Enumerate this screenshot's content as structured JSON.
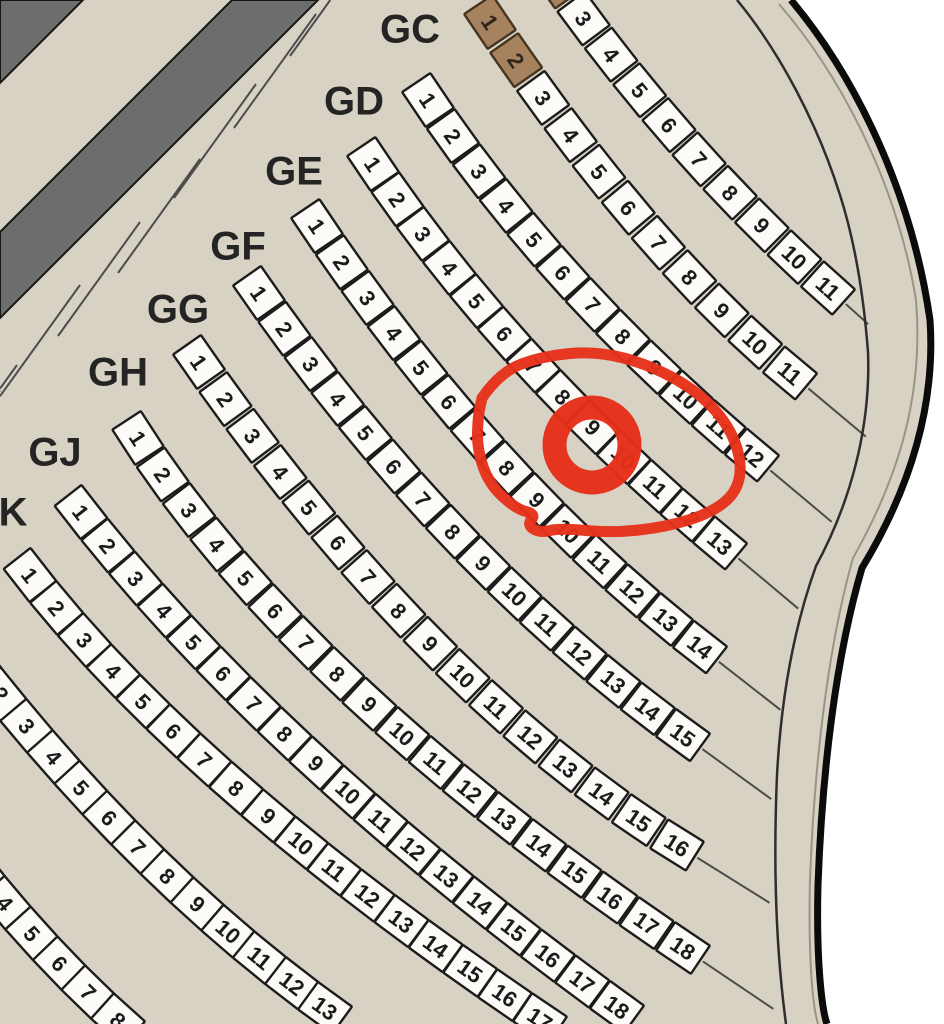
{
  "map": {
    "type": "venue-seating-chart",
    "background_color": "#d7d2c4",
    "outside_color": "#ffffff",
    "seat": {
      "fill": "#fcfbf8",
      "border": "#1c1c1c",
      "number_color": "#1b1b1b",
      "width": 42,
      "height": 34,
      "font_size": 22
    },
    "reserved_seat": {
      "fill": "#a6825e",
      "border": "#46341f",
      "number_color": "#312619"
    },
    "label_style": {
      "color": "#242424",
      "font_size": 40
    },
    "wall": {
      "fill": "#6d6d6d",
      "border": "#161616"
    },
    "boundary": {
      "thick_color": "#0b0b0b",
      "thin_color": "#2e2e2e",
      "faint_color": "#9a9484"
    },
    "divider_color": "#4c4c4c",
    "annotation": {
      "kind": "hand-drawn-red-circle",
      "color": "#e63019",
      "circled_row": "GE",
      "circled_seat_number": 9,
      "ring": {
        "cx": 592,
        "cy": 445,
        "r": 37.5,
        "stroke_width": 24
      },
      "outline_stroke_width": 11,
      "outline_points": [
        [
          482,
          398
        ],
        [
          500,
          372
        ],
        [
          543,
          356
        ],
        [
          597,
          351
        ],
        [
          650,
          365
        ],
        [
          697,
          391
        ],
        [
          728,
          424
        ],
        [
          742,
          461
        ],
        [
          737,
          492
        ],
        [
          711,
          513
        ],
        [
          666,
          527
        ],
        [
          612,
          533
        ],
        [
          560,
          528
        ],
        [
          540,
          533
        ],
        [
          527,
          525
        ],
        [
          536,
          514
        ],
        [
          516,
          509
        ],
        [
          489,
          484
        ],
        [
          477,
          449
        ],
        [
          478,
          416
        ]
      ]
    }
  },
  "rows": [
    {
      "id": "front",
      "label": null,
      "seat_count": 11,
      "numbers": [
        1,
        2,
        3,
        4,
        5,
        6,
        7,
        8,
        9,
        10,
        11
      ],
      "reserved": [
        1,
        2
      ],
      "start": [
        531,
        -56
      ],
      "end": [
        828,
        288
      ],
      "angle_start": 56,
      "angle_end": 42,
      "ext_len": 30
    },
    {
      "id": "GC",
      "label": "GC",
      "label_x": 410,
      "label_y": 28,
      "seat_count": 11,
      "numbers": [
        1,
        2,
        3,
        4,
        5,
        6,
        7,
        8,
        9,
        10,
        11
      ],
      "reserved": [
        1,
        2
      ],
      "start": [
        490,
        22
      ],
      "end": [
        790,
        373
      ],
      "angle_start": 56,
      "angle_end": 40,
      "ext_len": 75
    },
    {
      "id": "GD",
      "label": "GD",
      "label_x": 354,
      "label_y": 100,
      "seat_count": 12,
      "numbers": [
        1,
        2,
        3,
        4,
        5,
        6,
        7,
        8,
        9,
        10,
        11,
        12
      ],
      "reserved": [],
      "start": [
        428,
        100
      ],
      "end": [
        752,
        455
      ],
      "angle_start": 56,
      "angle_end": 40,
      "ext_len": 80
    },
    {
      "id": "GE",
      "label": "GE",
      "label_x": 294,
      "label_y": 170,
      "seat_count": 13,
      "numbers": [
        1,
        2,
        3,
        4,
        5,
        6,
        7,
        8,
        9,
        10,
        11,
        12,
        13
      ],
      "reserved": [],
      "start": [
        373,
        164
      ],
      "end": [
        720,
        543
      ],
      "angle_start": 56,
      "angle_end": 40,
      "ext_len": 78
    },
    {
      "id": "GF",
      "label": "GF",
      "label_x": 238,
      "label_y": 245,
      "seat_count": 14,
      "numbers": [
        1,
        2,
        3,
        4,
        5,
        6,
        7,
        8,
        9,
        10,
        11,
        12,
        13,
        14
      ],
      "reserved": [],
      "start": [
        317,
        226
      ],
      "end": [
        700,
        647
      ],
      "angle_start": 56,
      "angle_end": 38,
      "ext_len": 78
    },
    {
      "id": "GG",
      "label": "GG",
      "label_x": 178,
      "label_y": 308,
      "seat_count": 15,
      "numbers": [
        1,
        2,
        3,
        4,
        5,
        6,
        7,
        8,
        9,
        10,
        11,
        12,
        13,
        14,
        15
      ],
      "reserved": [],
      "start": [
        259,
        293
      ],
      "end": [
        683,
        735
      ],
      "angle_start": 55,
      "angle_end": 36,
      "ext_len": 85
    },
    {
      "id": "GH",
      "label": "GH",
      "label_x": 118,
      "label_y": 371,
      "seat_count": 16,
      "numbers": [
        1,
        2,
        3,
        4,
        5,
        6,
        7,
        8,
        9,
        10,
        11,
        12,
        13,
        14,
        15,
        16
      ],
      "reserved": [],
      "start": [
        199,
        362
      ],
      "end": [
        677,
        845
      ],
      "angle_start": 55,
      "angle_end": 32,
      "ext_len": 85
    },
    {
      "id": "GJ",
      "label": "GJ",
      "label_x": 55,
      "label_y": 451,
      "seat_count": 18,
      "numbers": [
        1,
        2,
        3,
        4,
        5,
        6,
        7,
        8,
        9,
        10,
        11,
        12,
        13,
        14,
        15,
        16,
        17,
        18
      ],
      "reserved": [],
      "start": [
        138,
        438
      ],
      "end": [
        683,
        948
      ],
      "angle_start": 57,
      "angle_end": 34,
      "ext_len": 85
    },
    {
      "id": "K",
      "label": "K",
      "label_x": 13,
      "label_y": 511,
      "seat_count": 18,
      "numbers": [
        1,
        2,
        3,
        4,
        5,
        6,
        7,
        8,
        9,
        10,
        11,
        12,
        13,
        14,
        15,
        16,
        17,
        18
      ],
      "reserved": [],
      "start": [
        81,
        512
      ],
      "end": [
        617,
        1007
      ],
      "angle_start": 52,
      "angle_end": 36,
      "ext_len": 0
    },
    {
      "id": "row-L",
      "label": null,
      "seat_count": 17,
      "numbers": [
        1,
        2,
        3,
        4,
        5,
        6,
        7,
        8,
        9,
        10,
        11,
        12,
        13,
        14,
        15,
        16,
        17
      ],
      "reserved": [],
      "start": [
        30,
        575
      ],
      "end": [
        540,
        1019
      ],
      "angle_start": 52,
      "angle_end": 34,
      "ext_len": 0
    },
    {
      "id": "row-M",
      "label": null,
      "seat_count": 13,
      "numbers": [
        1,
        2,
        3,
        4,
        5,
        6,
        7,
        8,
        9,
        10,
        11,
        12,
        13
      ],
      "reserved": [],
      "start": [
        -25,
        662
      ],
      "end": [
        325,
        1008
      ],
      "angle_start": 52,
      "angle_end": 36,
      "ext_len": 0
    },
    {
      "id": "row-N",
      "label": null,
      "seat_count": 8,
      "numbers": [
        1,
        2,
        3,
        4,
        5,
        6,
        7,
        8
      ],
      "reserved": [],
      "start": [
        -70,
        807
      ],
      "end": [
        118,
        1020
      ],
      "angle_start": 54,
      "angle_end": 42,
      "ext_len": 0
    }
  ]
}
